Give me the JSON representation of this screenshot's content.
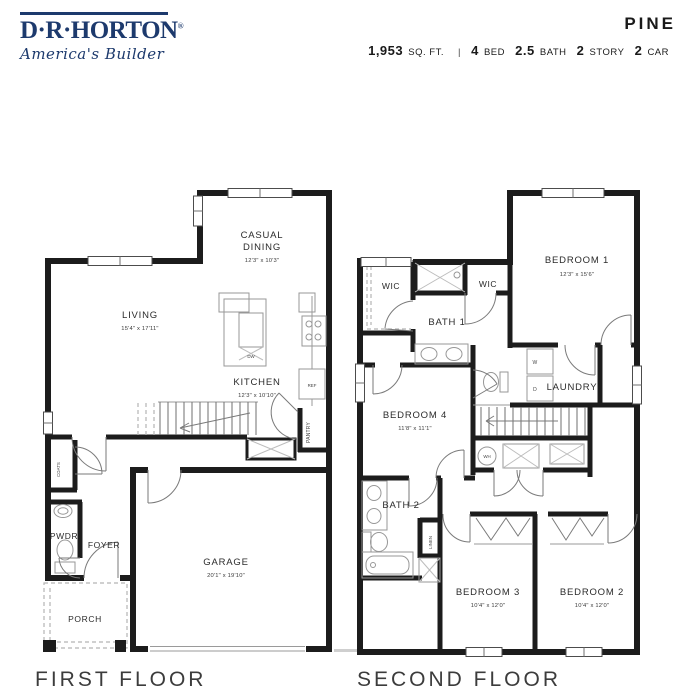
{
  "brand": {
    "name": "D·R·HORTON",
    "registered": "®",
    "tagline": "America's Builder"
  },
  "plan": {
    "name": "PINE",
    "sqft_value": "1,953",
    "sqft_label": "SQ. FT.",
    "divider": "|",
    "bed_value": "4",
    "bed_label": "BED",
    "bath_value": "2.5",
    "bath_label": "BATH",
    "story_value": "2",
    "story_label": "STORY",
    "car_value": "2",
    "car_label": "CAR"
  },
  "first_floor": {
    "title": "FIRST FLOOR",
    "rooms": {
      "living": {
        "name": "LIVING",
        "dims": "15'4\" x 17'11\""
      },
      "casual_dining": {
        "line1": "CASUAL",
        "line2": "DINING",
        "dims": "12'3\" x 10'3\""
      },
      "kitchen": {
        "name": "KITCHEN",
        "dims": "12'3\" x 10'10\""
      },
      "garage": {
        "name": "GARAGE",
        "dims": "20'1\" x 19'10\""
      },
      "foyer": {
        "name": "FOYER"
      },
      "pwdr": {
        "name": "PWDR"
      },
      "porch": {
        "name": "PORCH"
      },
      "pantry": {
        "name": "PANTRY"
      },
      "coats": {
        "name": "COATS"
      },
      "dw": "DW",
      "ref": "REF"
    }
  },
  "second_floor": {
    "title": "SECOND FLOOR",
    "rooms": {
      "bedroom1": {
        "name": "BEDROOM 1",
        "dims": "12'3\" x 15'6\""
      },
      "bedroom2": {
        "name": "BEDROOM 2",
        "dims": "10'4\" x 12'0\""
      },
      "bedroom3": {
        "name": "BEDROOM 3",
        "dims": "10'4\" x 12'0\""
      },
      "bedroom4": {
        "name": "BEDROOM 4",
        "dims": "11'8\" x 11'1\""
      },
      "bath1": {
        "name": "BATH 1"
      },
      "bath2": {
        "name": "BATH 2"
      },
      "laundry": {
        "name": "LAUNDRY"
      },
      "wic_left": {
        "name": "WIC"
      },
      "wic_right": {
        "name": "WIC"
      },
      "linen": {
        "name": "LINEN"
      },
      "wh": "WH",
      "washer": "W",
      "dryer": "D"
    }
  },
  "colors": {
    "brand_navy": "#1d3a6d",
    "wall_black": "#1c1c1c",
    "text_dark": "#1a1a1a"
  }
}
